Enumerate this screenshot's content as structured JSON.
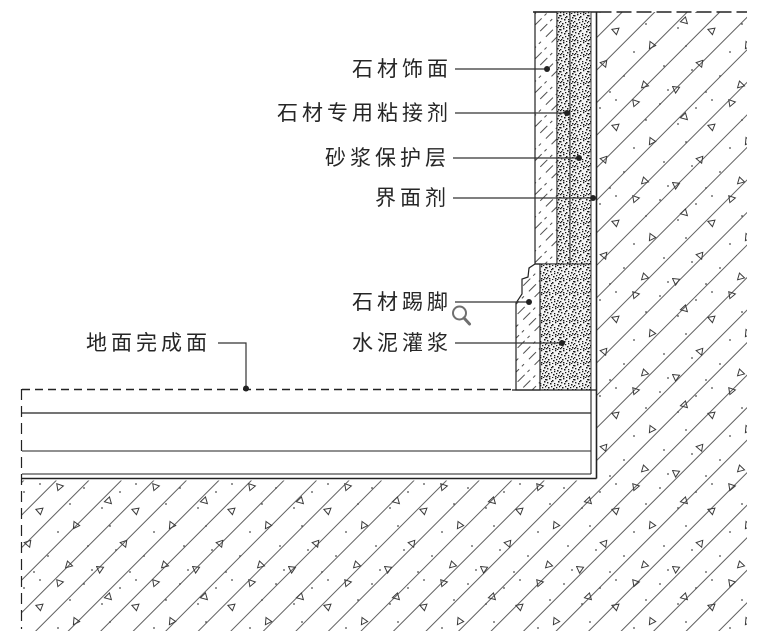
{
  "drawing": {
    "type": "construction-detail-section",
    "labels": {
      "stone_facing": "石材饰面",
      "stone_adhesive": "石材专用粘接剂",
      "mortar_protection": "砂浆保护层",
      "interface_agent": "界面剂",
      "stone_skirting": "石材踢脚",
      "cement_grout": "水泥灌浆",
      "floor_finish": "地面完成面"
    },
    "icons": {
      "watermark": "magnifier"
    },
    "colors": {
      "background": "#ffffff",
      "line": "#222222",
      "hatch_line": "#4f4f4f",
      "concrete_line": "#606060",
      "stipple": "#161616",
      "watermark": "#6f6f6f"
    }
  }
}
